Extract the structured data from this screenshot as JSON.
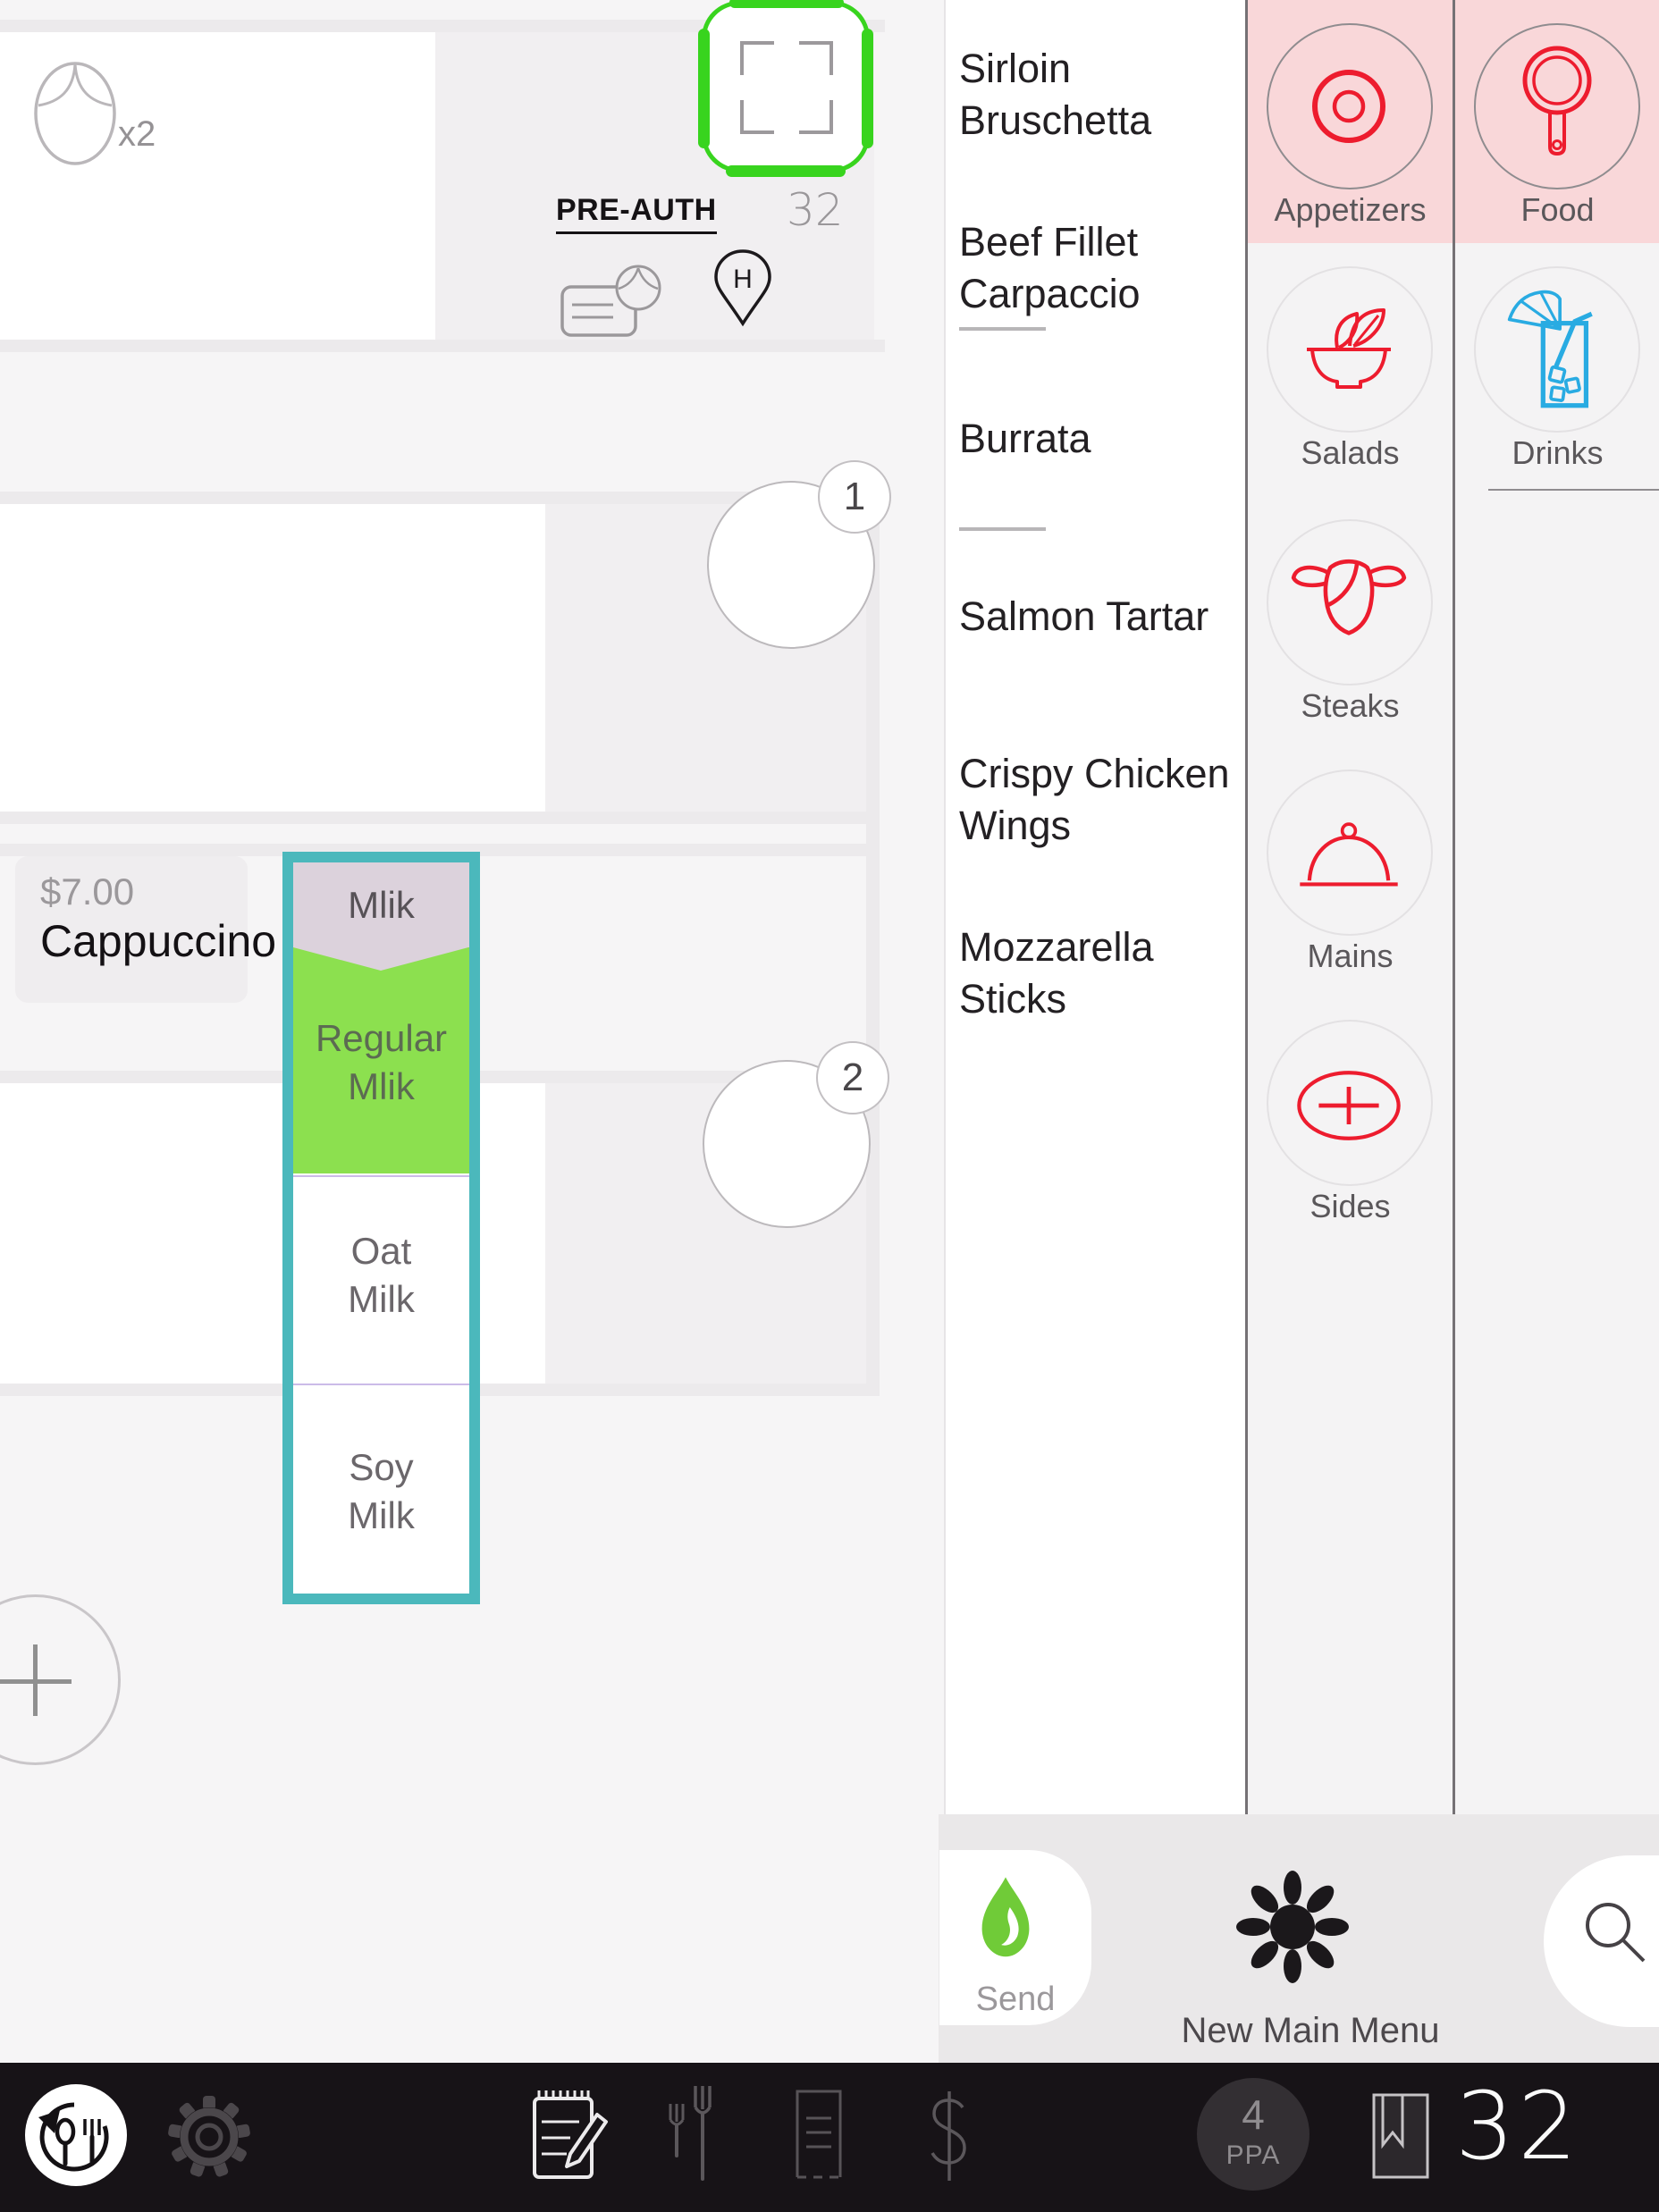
{
  "order_panel": {
    "item_plate_quantity": "x2",
    "preauth_label": "PRE-AUTH",
    "table_number": "32",
    "location_pin_letter": "H",
    "seat_badge_1": "1",
    "seat_badge_2": "2",
    "item": {
      "price": "$7.00",
      "name": "Cappuccino"
    },
    "modifier_popup": {
      "header": "Mlik",
      "selected_option": "Regular Mlik",
      "options": [
        {
          "label": "Regular Mlik",
          "line1": "Regular",
          "line2": "Mlik",
          "selected": true
        },
        {
          "label": "Oat Milk",
          "line1": "Oat",
          "line2": "Milk",
          "selected": false
        },
        {
          "label": "Soy Milk",
          "line1": "Soy",
          "line2": "Milk",
          "selected": false
        }
      ]
    }
  },
  "menu": {
    "items": [
      {
        "label": "Sirloin Bruschetta",
        "line1": "Sirloin",
        "line2": "Bruschetta"
      },
      {
        "label": "Beef Fillet Carpaccio",
        "line1": "Beef Fillet",
        "line2": "Carpaccio"
      },
      {
        "label": "Burrata",
        "line1": "Burrata",
        "line2": ""
      },
      {
        "label": "Salmon Tartar",
        "line1": "Salmon Tartar",
        "line2": ""
      },
      {
        "label": "Crispy Chicken Wings",
        "line1": "Crispy Chicken",
        "line2": "Wings"
      },
      {
        "label": "Mozzarella Sticks",
        "line1": "Mozzarella",
        "line2": "Sticks"
      }
    ]
  },
  "categories": {
    "column1": [
      {
        "label": "Appetizers",
        "icon": "target-rings-icon",
        "selected": true
      },
      {
        "label": "Salads",
        "icon": "salad-bowl-icon",
        "selected": false
      },
      {
        "label": "Steaks",
        "icon": "cow-head-icon",
        "selected": false
      },
      {
        "label": "Mains",
        "icon": "cloche-icon",
        "selected": false
      },
      {
        "label": "Sides",
        "icon": "plus-ellipse-icon",
        "selected": false
      }
    ],
    "column2": [
      {
        "label": "Food",
        "icon": "pan-icon",
        "selected": true
      },
      {
        "label": "Drinks",
        "icon": "cocktail-glass-icon",
        "selected": false
      }
    ]
  },
  "actions": {
    "send_label": "Send",
    "new_menu_label": "New Main Menu"
  },
  "bottom_bar": {
    "ppa_value": "4",
    "ppa_label": "PPA",
    "screen_number": "32"
  },
  "colors": {
    "accent_teal": "#4bb8bc",
    "selected_green": "#8ce04f",
    "scan_green": "#38d41e",
    "flame_green": "#70cb38",
    "category_pink": "#f9d7d9",
    "icon_red": "#ed1c2e",
    "drink_blue": "#29abe2",
    "bar_black": "#171317",
    "popup_header_mauve": "#dcd2dc"
  },
  "icons": {
    "plate-icon": "oval plate outline",
    "scan-frame-icon": "crop corners in green rounded square",
    "card-plate-icon": "payment card with plate",
    "location-pin-icon": "map pin with letter",
    "plus-icon": "+",
    "target-rings-icon": "concentric circles",
    "pan-icon": "frying pan top view",
    "salad-bowl-icon": "bowl with leaves",
    "cocktail-glass-icon": "glass with umbrella and straw",
    "cow-head-icon": "cow head outline",
    "cloche-icon": "serving dome",
    "plus-ellipse-icon": "ellipse with plus",
    "flame-icon": "flame",
    "sun-icon": "black sun flower",
    "search-icon": "magnifier",
    "undo-cutlery-icon": "circular arrow with spoon and fork",
    "gear-icon": "gear",
    "notepad-pencil-icon": "notepad with pencil",
    "forks-icon": "two forks",
    "receipt-icon": "receipt document",
    "dollar-icon": "$",
    "book-bookmark-icon": "book with bookmark"
  }
}
